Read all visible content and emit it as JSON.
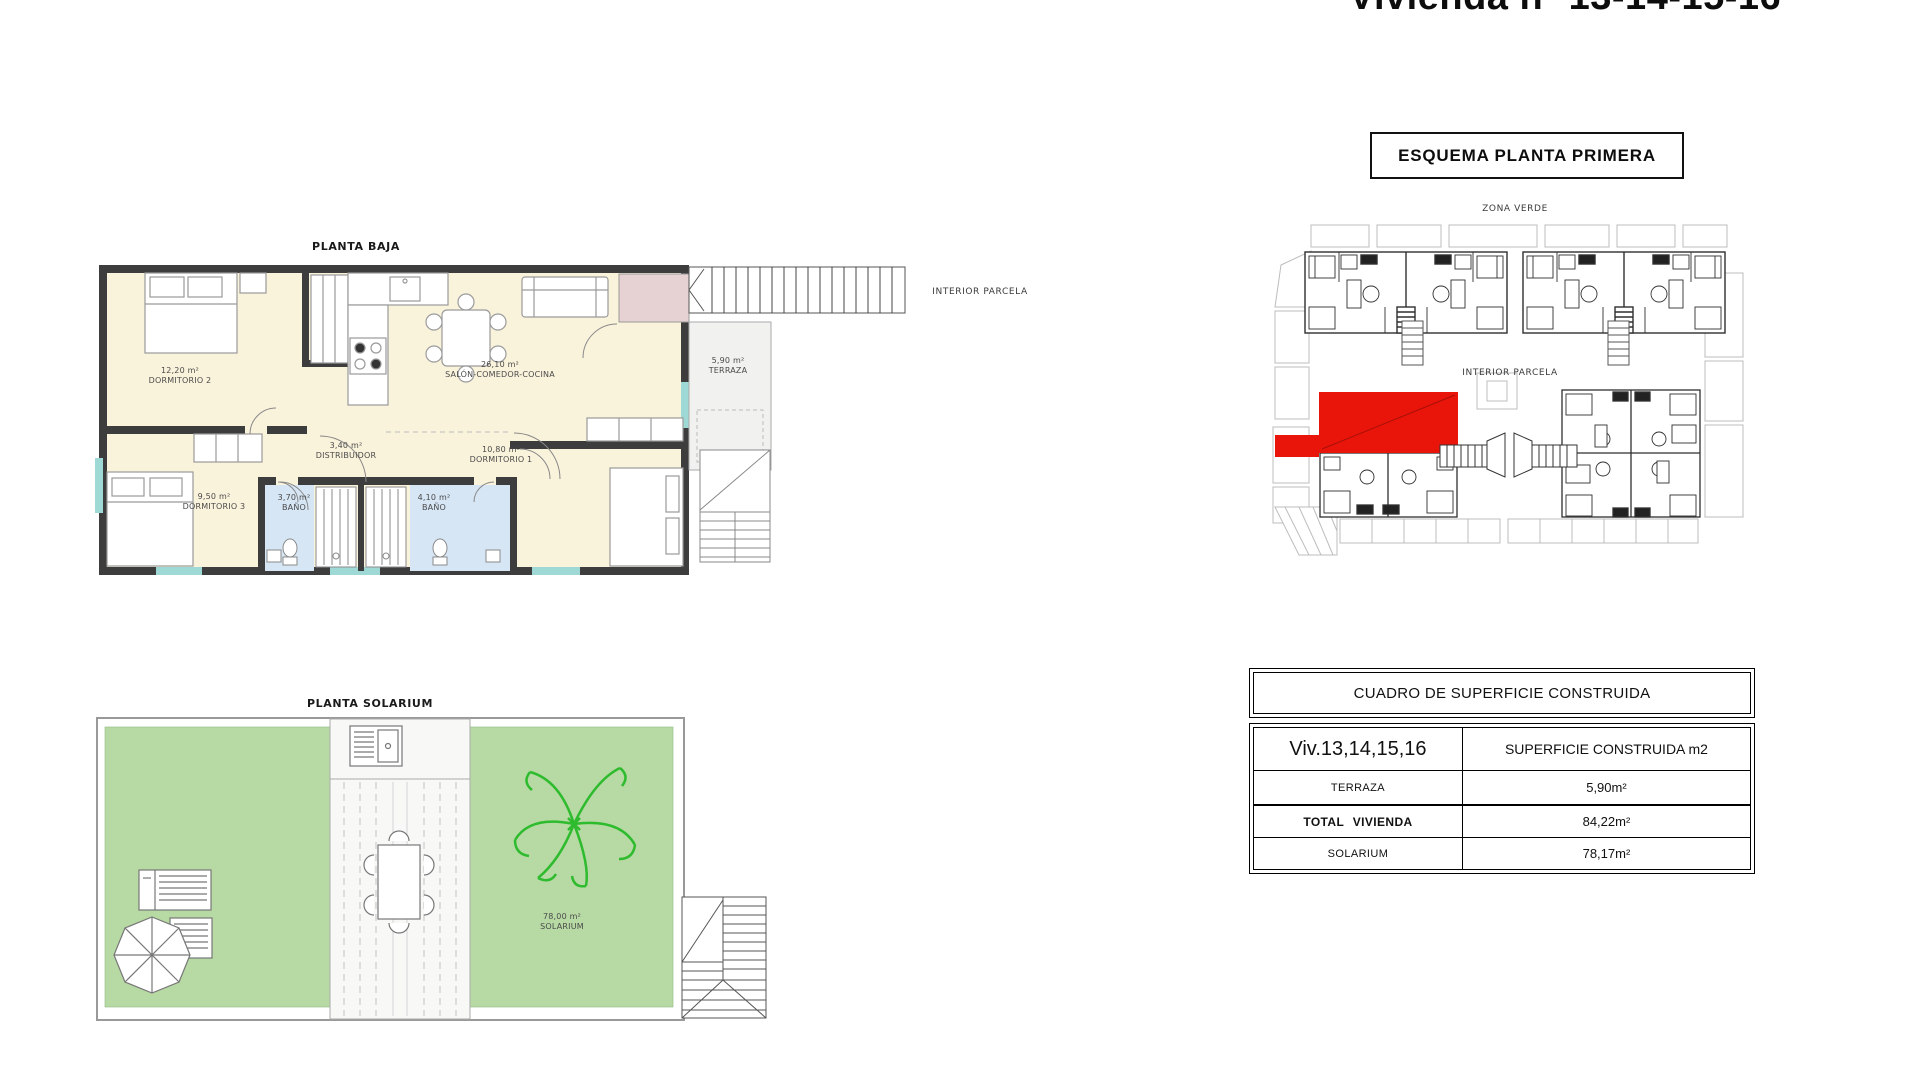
{
  "page_title": "Vivienda nº 13-14-15-16",
  "planta_baja": {
    "title": "PLANTA BAJA",
    "rooms": [
      {
        "area": "12,20 m²",
        "name": "DORMITORIO 2"
      },
      {
        "area": "26,10 m²",
        "name": "SALÓN-COMEDOR-COCINA"
      },
      {
        "area": "3,40 m²",
        "name": "DISTRIBUIDOR"
      },
      {
        "area": "10,80 m²",
        "name": "DORMITORIO 1"
      },
      {
        "area": "9,50 m²",
        "name": "DORMITORIO 3"
      },
      {
        "area": "3,70 m²",
        "name": "BAÑO"
      },
      {
        "area": "4,10 m²",
        "name": "BAÑO"
      },
      {
        "area": "5,90 m²",
        "name": "TERRAZA"
      }
    ],
    "exterior_label": "INTERIOR PARCELA"
  },
  "planta_solarium": {
    "title": "PLANTA SOLARIUM",
    "room": {
      "area": "78,00 m²",
      "name": "SOLARIUM"
    }
  },
  "esquema": {
    "title": "ESQUEMA PLANTA PRIMERA",
    "zona_verde": "ZONA VERDE",
    "interior_parcela": "INTERIOR PARCELA"
  },
  "table": {
    "title": "CUADRO DE SUPERFICIE CONSTRUIDA",
    "col1_header": "Viv.13,14,15,16",
    "col2_header": "SUPERFICIE CONSTRUIDA m2",
    "rows": [
      {
        "label": "TERRAZA",
        "value": "5,90m²"
      },
      {
        "label": "TOTAL VIVIENDA",
        "value": "84,22m²"
      },
      {
        "label": "SOLARIUM",
        "value": "78,17m²"
      }
    ]
  },
  "colors": {
    "highlight_red": "#e9150b",
    "room_cream": "#faf3dc",
    "bath_blue": "#d7e6f5",
    "solarium_green": "#b7d9a4",
    "palm_green": "#2ebb2e",
    "porch_pink": "#e6d2d2",
    "wall_dark": "#3d3d3d",
    "window_teal": "#9fd9d6"
  }
}
